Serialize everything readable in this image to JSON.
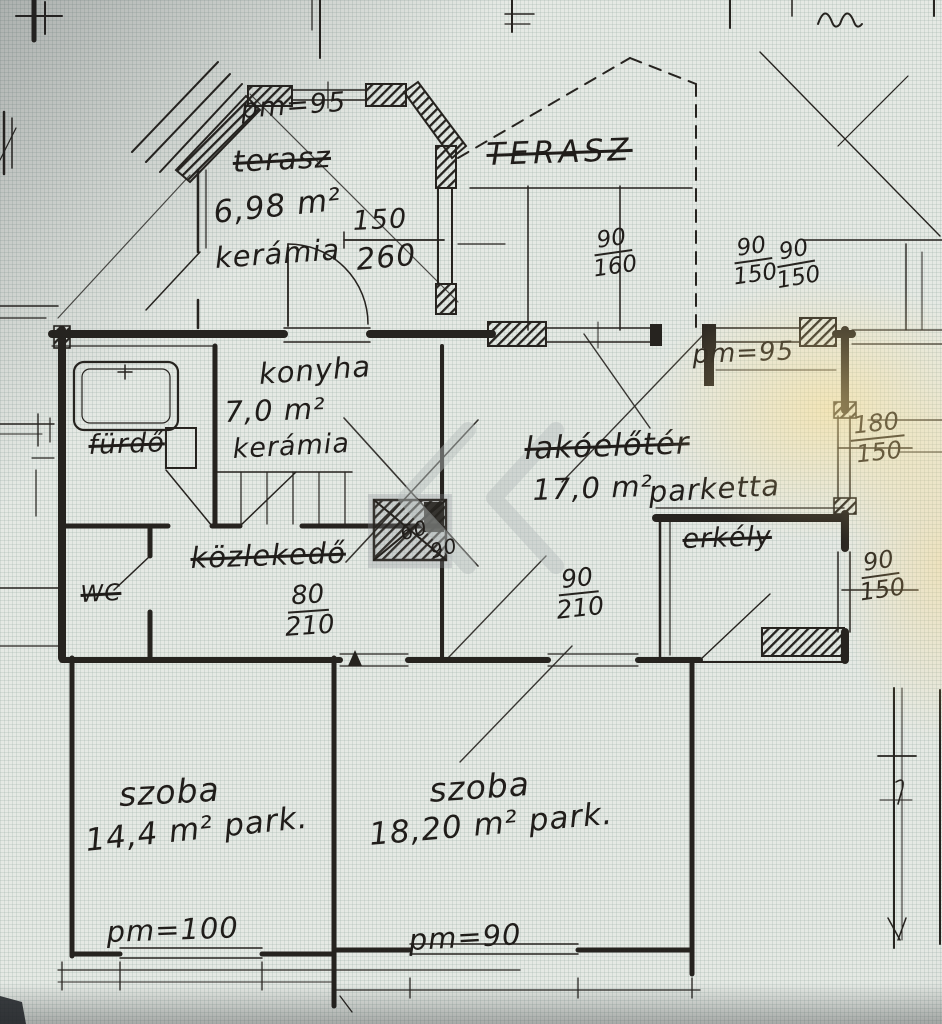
{
  "colors": {
    "ink": "#26231f",
    "paper": "#e5e9e4",
    "lamp_glow": "#f3dfa8",
    "watermark": "#b6bdbc"
  },
  "rooms": {
    "porch": {
      "pm_label": "pm=95",
      "crossed_name": "terasz",
      "area": "6,98 m²",
      "floor": "kerámia",
      "opening_w": "150",
      "opening_h": "260"
    },
    "terrace": {
      "name": "TERASZ",
      "pm_label": "pm=95",
      "window1": {
        "w": "90",
        "h": "160"
      },
      "window2": {
        "w": "90",
        "h": "150"
      },
      "window3": {
        "w": "90",
        "h": "150"
      }
    },
    "bathroom": {
      "name": "fürdő"
    },
    "wc": {
      "name": "WC"
    },
    "kitchen": {
      "name": "konyha",
      "area": "7,0 m²",
      "floor": "kerámia"
    },
    "hall": {
      "name": "közlekedő",
      "door_w": "80",
      "door_h": "210",
      "dim_a": "60",
      "dim_b": "90"
    },
    "living_hall": {
      "name": "lakóelőtér",
      "area": "17,0 m²",
      "floor": "parketta",
      "door_w": "90",
      "door_h": "210"
    },
    "balcony": {
      "name": "erkély",
      "window1": {
        "w": "180",
        "h": "150"
      },
      "window2": {
        "w": "90",
        "h": "150"
      }
    },
    "room1": {
      "name": "szoba",
      "area": "14,4 m² park.",
      "pm_label": "pm=100"
    },
    "room2": {
      "name": "szoba",
      "area": "18,20 m² park.",
      "pm_label": "pm=90"
    }
  }
}
